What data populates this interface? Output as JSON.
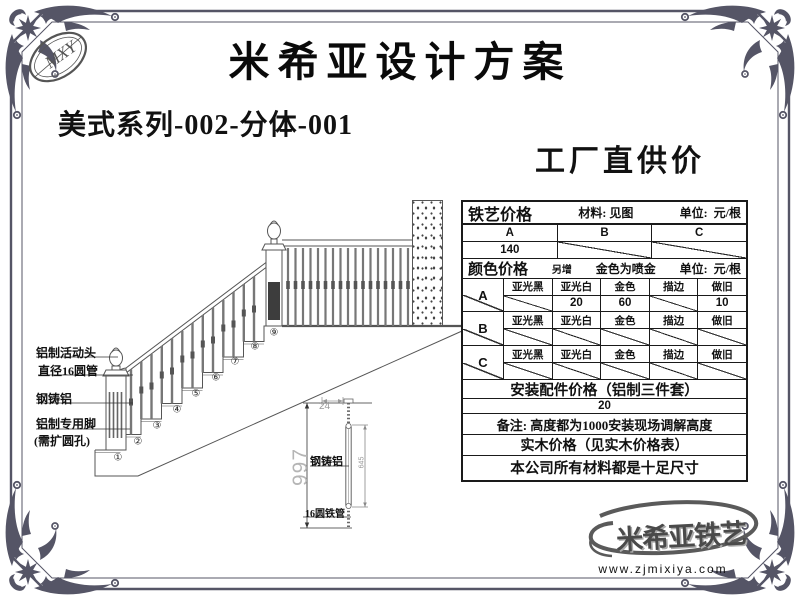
{
  "header": {
    "title": "米希亚设计方案",
    "logo_text": "MXY"
  },
  "subtitle": "美式系列-002-分体-001",
  "price_heading": "工厂直供价",
  "stair_drawing": {
    "labels": {
      "l1": "铝制活动头",
      "l2": "直径16圆管",
      "l3": "钢铸铝",
      "l4": "铝制专用脚",
      "l5": "(需扩圆孔)"
    },
    "step_numbers": [
      "①",
      "②",
      "③",
      "④",
      "⑤",
      "⑥",
      "⑦",
      "⑧",
      "⑨"
    ]
  },
  "detail_drawing": {
    "height_dim": "997",
    "top_dim": "24",
    "mid_dim": "645",
    "label_top": "钢铸铝",
    "label_bottom": "16圆铁管"
  },
  "price_table": {
    "iron_section": {
      "title": "铁艺价格",
      "material": "材料: 见图",
      "unit_label": "单位:",
      "unit": "元/根",
      "types": [
        "A",
        "B",
        "C"
      ],
      "prices": [
        "140",
        "",
        ""
      ]
    },
    "color_section": {
      "title": "颜色价格",
      "surcharge_note": "另增",
      "gold_note": "金色为喷金",
      "unit_label": "单位:",
      "unit": "元/根",
      "columns": [
        "亚光黑",
        "亚光白",
        "金色",
        "描边",
        "做旧"
      ],
      "rows": [
        {
          "type": "A",
          "values": [
            "",
            "20",
            "60",
            "",
            "10"
          ]
        },
        {
          "type": "B",
          "values": [
            "",
            "",
            "",
            "",
            ""
          ]
        },
        {
          "type": "C",
          "values": [
            "",
            "",
            "",
            "",
            ""
          ]
        }
      ]
    },
    "footer_rows": [
      "安装配件价格（铝制三件套）",
      "20",
      "备注: 高度都为1000安装现场调解高度",
      "实木价格（见实木价格表）",
      "本公司所有材料都是十足尺寸"
    ]
  },
  "footer": {
    "logo_text": "米希亚铁艺",
    "website": "www.zjmixiya.com"
  }
}
